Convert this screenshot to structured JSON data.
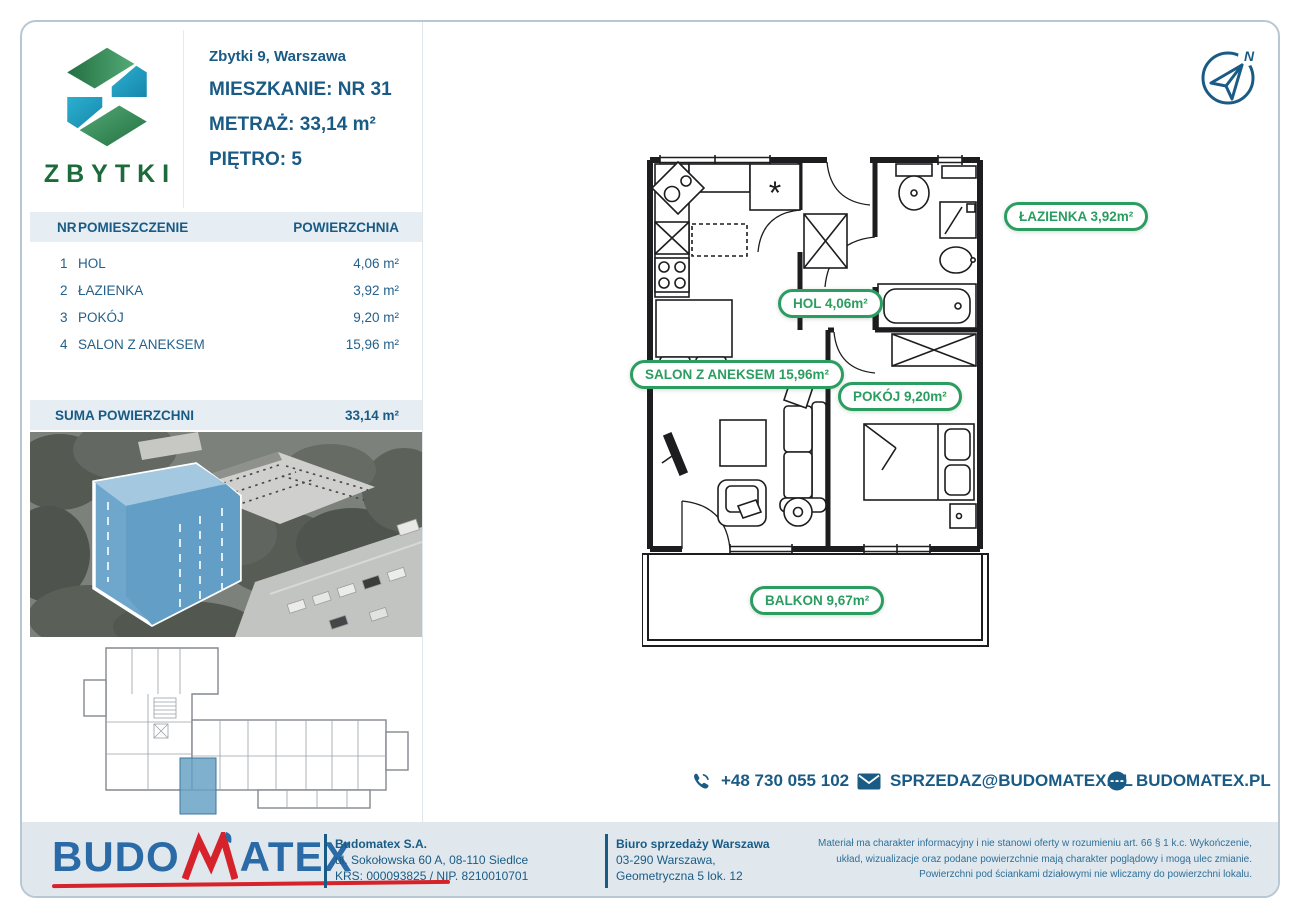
{
  "colors": {
    "blue": "#1a5b85",
    "green": "#2b9d60",
    "logo_green_dark": "#236f41",
    "logo_green_light": "#54ab77",
    "logo_teal": "#1d9dc0",
    "red": "#d6232b",
    "band_bg": "#e6edf3",
    "footer_bg": "#e0e8ee",
    "highlight_blue": "#6fa7cc"
  },
  "logo": {
    "name": "ZBYTKI"
  },
  "header": {
    "address": "Zbytki 9, Warszawa",
    "apartment_label": "MIESZKANIE:",
    "apartment_value": "NR 31",
    "area_label": "METRAŻ:",
    "area_value": "33,14 m²",
    "floor_label": "PIĘTRO:",
    "floor_value": "5"
  },
  "table": {
    "col_nr": "NR",
    "col_room": "POMIESZCZENIE",
    "col_area": "POWIERZCHNIA",
    "rows": [
      {
        "nr": "1",
        "room": "HOL",
        "area": "4,06 m²"
      },
      {
        "nr": "2",
        "room": "ŁAZIENKA",
        "area": "3,92 m²"
      },
      {
        "nr": "3",
        "room": "POKÓJ",
        "area": "9,20 m²"
      },
      {
        "nr": "4",
        "room": "SALON Z ANEKSEM",
        "area": "15,96 m²"
      }
    ],
    "sum_label": "SUMA POWIERZCHNI",
    "sum_value": "33,14 m²"
  },
  "plan": {
    "labels": {
      "lazienka": "ŁAZIENKA 3,92m²",
      "hol": "HOL 4,06m²",
      "salon": "SALON Z ANEKSEM 15,96m²",
      "pokoj": "POKÓJ 9,20m²",
      "balkon": "BALKON 9,67m²"
    },
    "kitchen_mark": "*",
    "compass_north": "N"
  },
  "contacts": {
    "phone": "+48 730 055 102",
    "email": "SPRZEDAZ@BUDOMATEX.PL",
    "website": "BUDOMATEX.PL"
  },
  "footer": {
    "brand_part1": "BUDO",
    "brand_m": "M",
    "brand_part2": "ATEX",
    "company_name": "Budomatex S.A.",
    "company_address": "ul. Sokołowska 60 A, 08-110 Siedlce",
    "company_ids": "KRS: 000093825 / NIP. 8210010701",
    "office_name": "Biuro sprzedaży Warszawa",
    "office_line1": "03-290 Warszawa,",
    "office_line2": "Geometryczna 5 lok. 12",
    "disclaimer": "Materiał ma charakter informacyjny i nie stanowi oferty w rozumieniu art. 66 § 1 k.c. Wykończenie, układ, wizualizacje oraz podane powierzchnie mają charakter poglądowy i mogą ulec zmianie. Powierzchni pod ściankami działowymi nie wliczamy do powierzchni lokalu."
  }
}
